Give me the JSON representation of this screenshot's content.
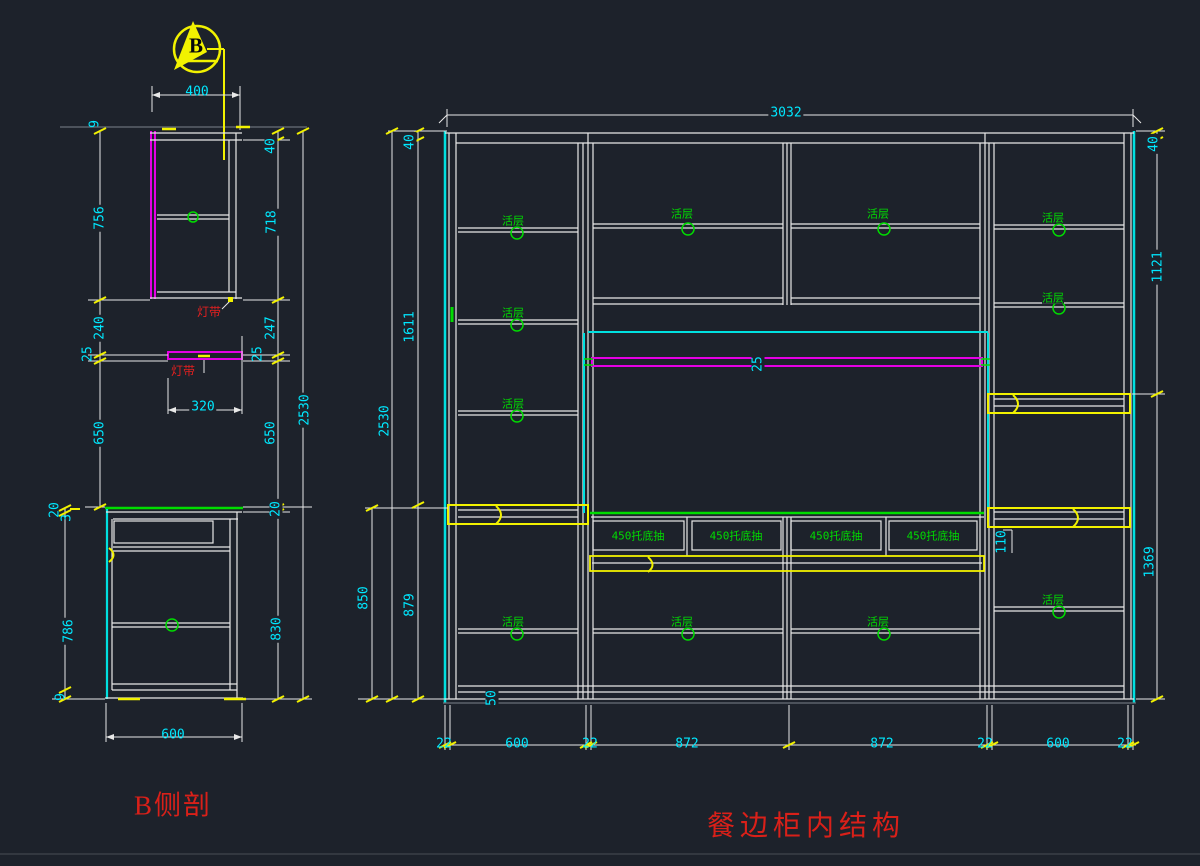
{
  "canvas": {
    "bg": "#1d222b"
  },
  "colors": {
    "line_white": "#e8e8e8",
    "dim_cyan": "#00e8ff",
    "highlight_cyan": "#00e0e0",
    "green": "#00dc00",
    "magenta": "#e400e4",
    "yellow": "#f2f200",
    "red": "#d92019",
    "gray": "#6a7078"
  },
  "side_view": {
    "title": "B侧剖",
    "section_marker_letter": "B",
    "light_strip_label": "灯带",
    "dims": {
      "top_width": "400",
      "mid_depth": "320",
      "bottom_width": "600",
      "overall_height": "2530",
      "left_col": [
        "9",
        "756",
        "240",
        "25",
        "650"
      ],
      "lower_left_col": [
        "20",
        "3",
        "786",
        "9"
      ],
      "right_col": [
        "40",
        "718",
        "247",
        "25",
        "650",
        "20",
        "830"
      ]
    }
  },
  "main_view": {
    "title": "餐边柜内结构",
    "shelf_label": "活层",
    "drawer_label": "450托底抽",
    "dims": {
      "top_width": "3032",
      "strip_thickness": "25",
      "toe_kick": "50",
      "left": {
        "top_rail": "40",
        "upper": "1611",
        "overall": "2530",
        "counter": "850",
        "lower": "879"
      },
      "right": {
        "top_rail": "40",
        "upper": "1121",
        "lower": "1369",
        "shelf_gap": "110"
      },
      "bottom": [
        "22",
        "600",
        "22",
        "872",
        "872",
        "22",
        "600",
        "22"
      ]
    }
  }
}
